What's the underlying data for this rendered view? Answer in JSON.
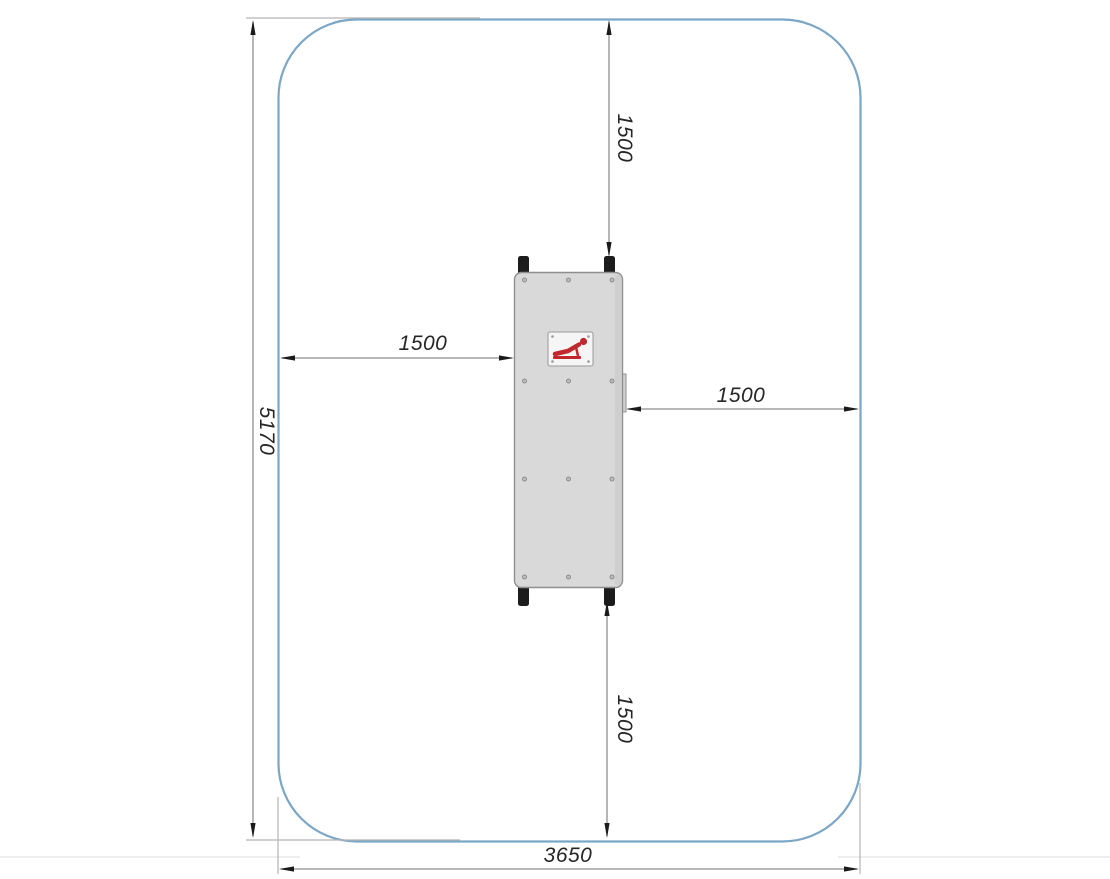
{
  "drawing": {
    "dimensions": {
      "total_height": "5170",
      "total_width": "3650",
      "clearance_top": "1500",
      "clearance_left": "1500",
      "clearance_right": "1500",
      "clearance_bottom": "1500"
    },
    "icons": {
      "equipment_label": "pushup-figure-icon"
    },
    "colors": {
      "boundary_blue": "#7ba6c6",
      "dim_line_gray": "#8e8e8e",
      "extension_line_gray": "#b3b3b3",
      "arrow_black": "#1a1a1a",
      "text_color": "#262626",
      "plate_fill": "#d9d9d9",
      "plate_stroke": "#8f8f8f",
      "plate_shadow": "#c6c6c6",
      "leg_black": "#1c1c1c",
      "label_plate_fill": "#f5f5f5",
      "figure_red": "#c1272d",
      "canvas_edge": "#e9e9e9"
    }
  }
}
